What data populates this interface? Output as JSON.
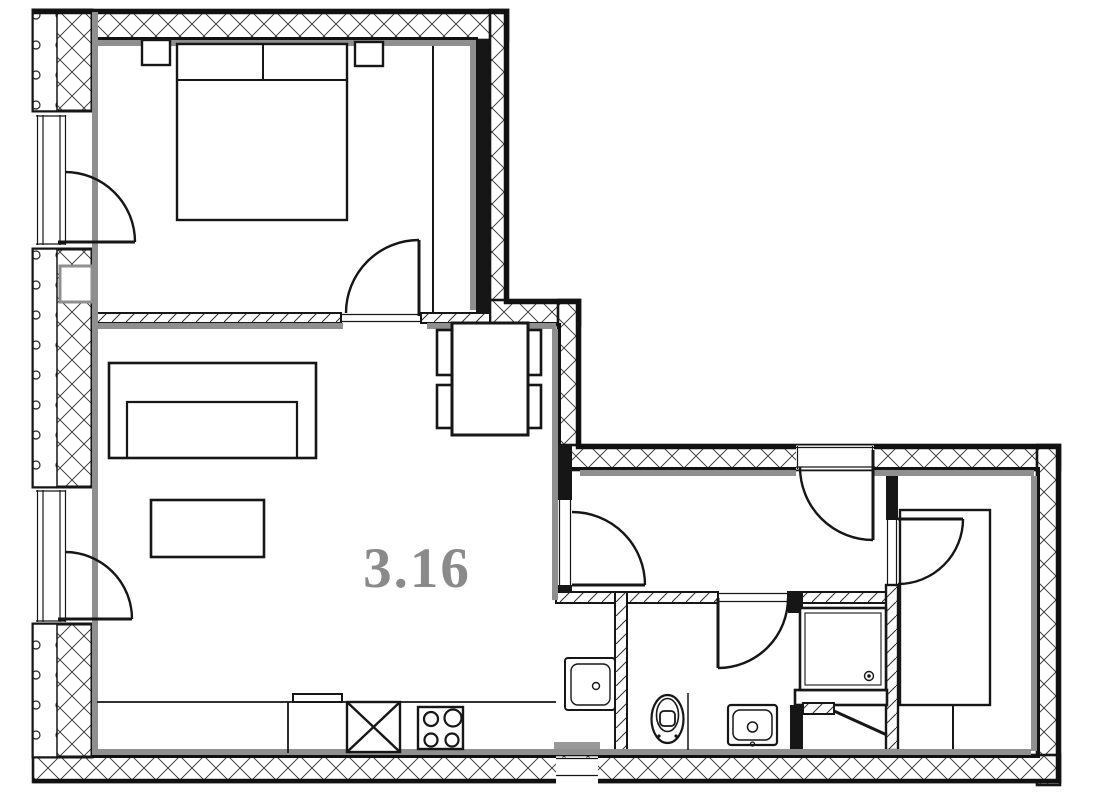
{
  "floor_plan": {
    "room_label": "3.16",
    "colors": {
      "line": "#161616",
      "inner_face": "#8f8f8f",
      "label": "#8a8a8a",
      "background": "#ffffff"
    }
  }
}
